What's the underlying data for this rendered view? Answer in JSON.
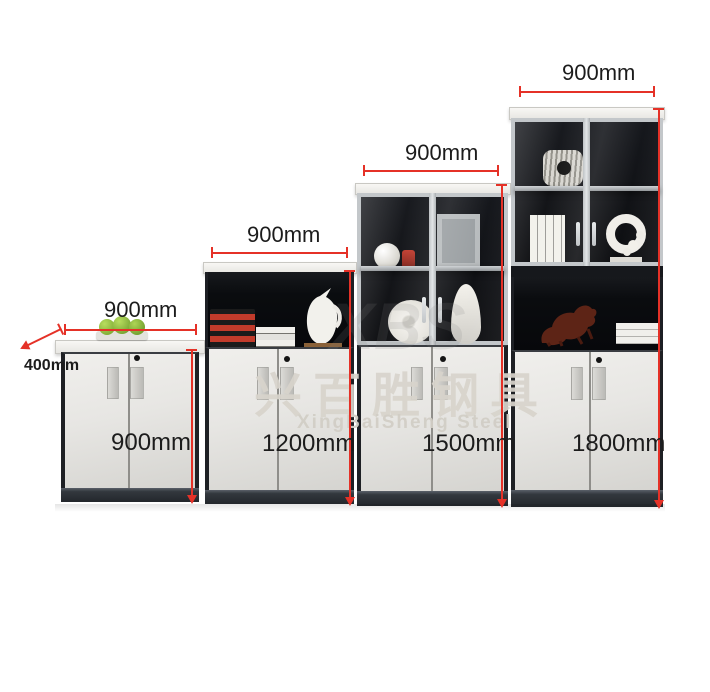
{
  "watermark": {
    "chinese": "兴百胜钢具",
    "english": "XingBaiSheng Steel",
    "logo": "XBS"
  },
  "cabinets": [
    {
      "id": "cabinet-900",
      "width_label": "900mm",
      "depth_label": "400mm",
      "height_label": "900mm"
    },
    {
      "id": "cabinet-1200",
      "width_label": "900mm",
      "height_label": "1200mm"
    },
    {
      "id": "cabinet-1500",
      "width_label": "900mm",
      "height_label": "1500mm"
    },
    {
      "id": "cabinet-1800",
      "width_label": "900mm",
      "height_label": "1800mm"
    }
  ],
  "colors": {
    "dimension_red": "#e53127",
    "door_white": "#e9e8e5",
    "cabinet_black": "#0d0f12",
    "plinth_gray": "#2c3137",
    "frame_silver": "#c4c8cb",
    "watermark_gray": "#d8d4cc"
  }
}
